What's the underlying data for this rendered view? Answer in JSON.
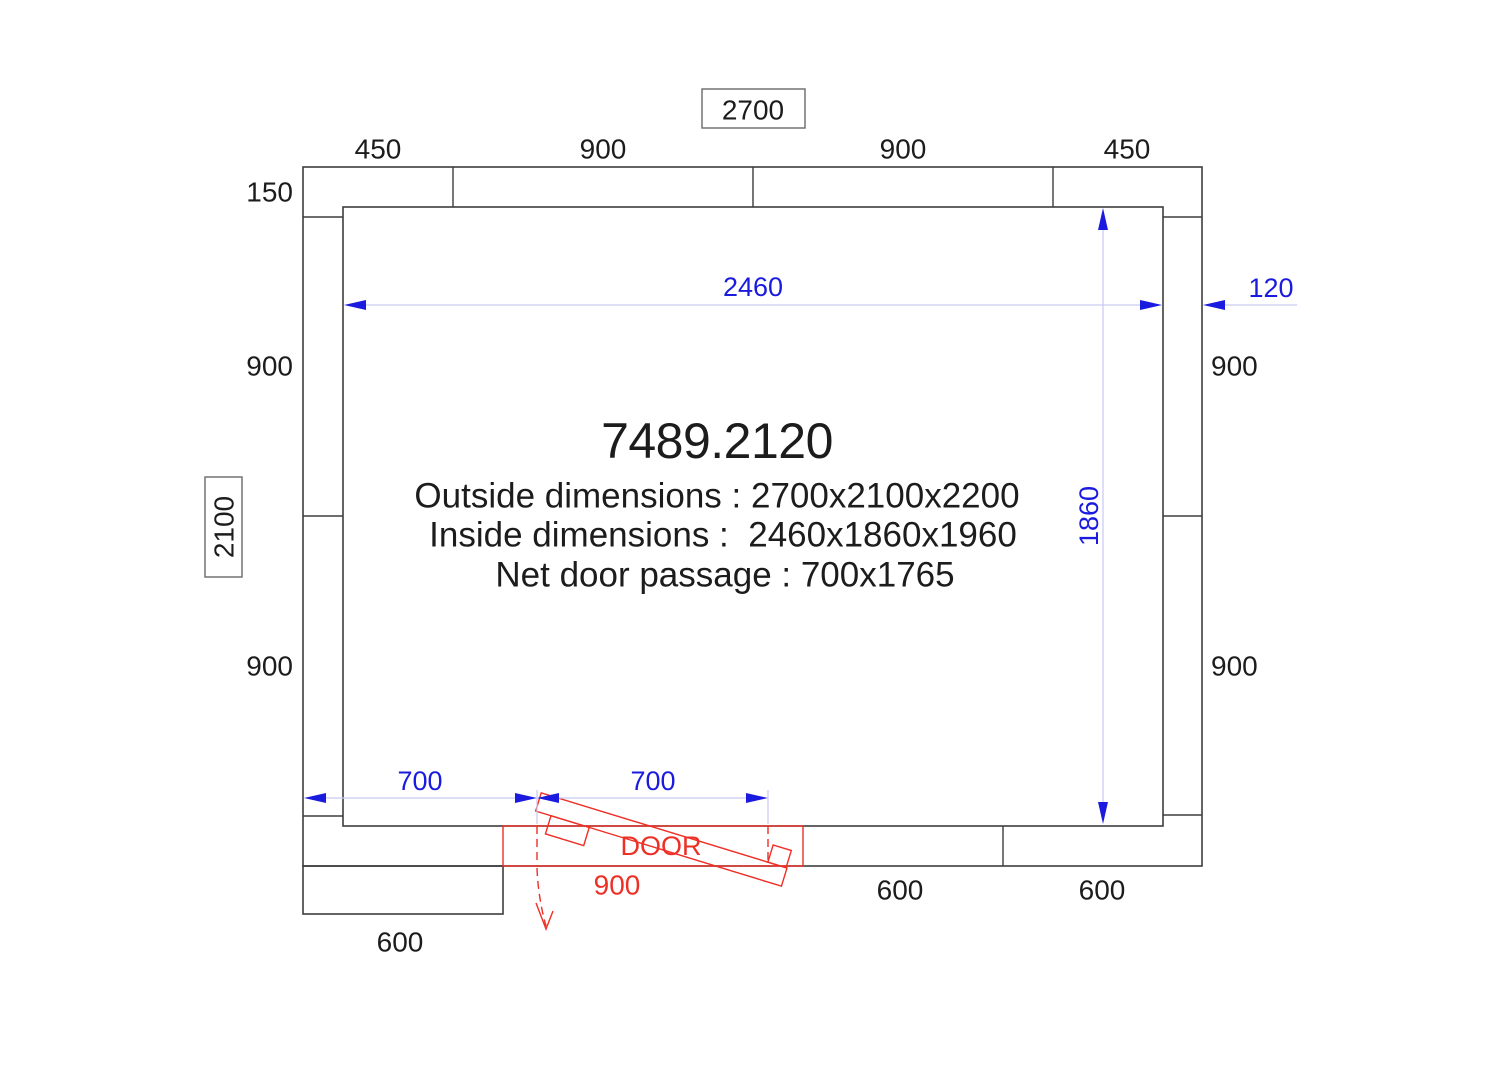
{
  "title_block": {
    "model": "7489.2120",
    "outside": "Outside dimensions : 2700x2100x2200",
    "inside": "Inside dimensions :  2460x1860x1960",
    "door_passage": "Net door passage : 700x1765"
  },
  "overall": {
    "width_label": "2700",
    "height_label": "2100"
  },
  "panels": {
    "top_segments": [
      "450",
      "900",
      "900",
      "450"
    ],
    "left_segments": [
      "150",
      "900",
      "900"
    ],
    "right_segments": [
      "900",
      "900"
    ],
    "bottom_segments": [
      "600",
      "600"
    ],
    "bottom_extension": "600"
  },
  "inner": {
    "width": "2460",
    "height": "1860"
  },
  "wall": {
    "thickness": "120"
  },
  "door": {
    "label": "DOOR",
    "panel_width": "900",
    "offset_left": "700",
    "net_passage": "700"
  },
  "colors": {
    "line": "#3d3d3d",
    "text": "#1c1c1c",
    "blue": "#1b1be0",
    "dim_line": "#c9c9f2",
    "red": "#ee2f26",
    "bg": "#ffffff"
  }
}
